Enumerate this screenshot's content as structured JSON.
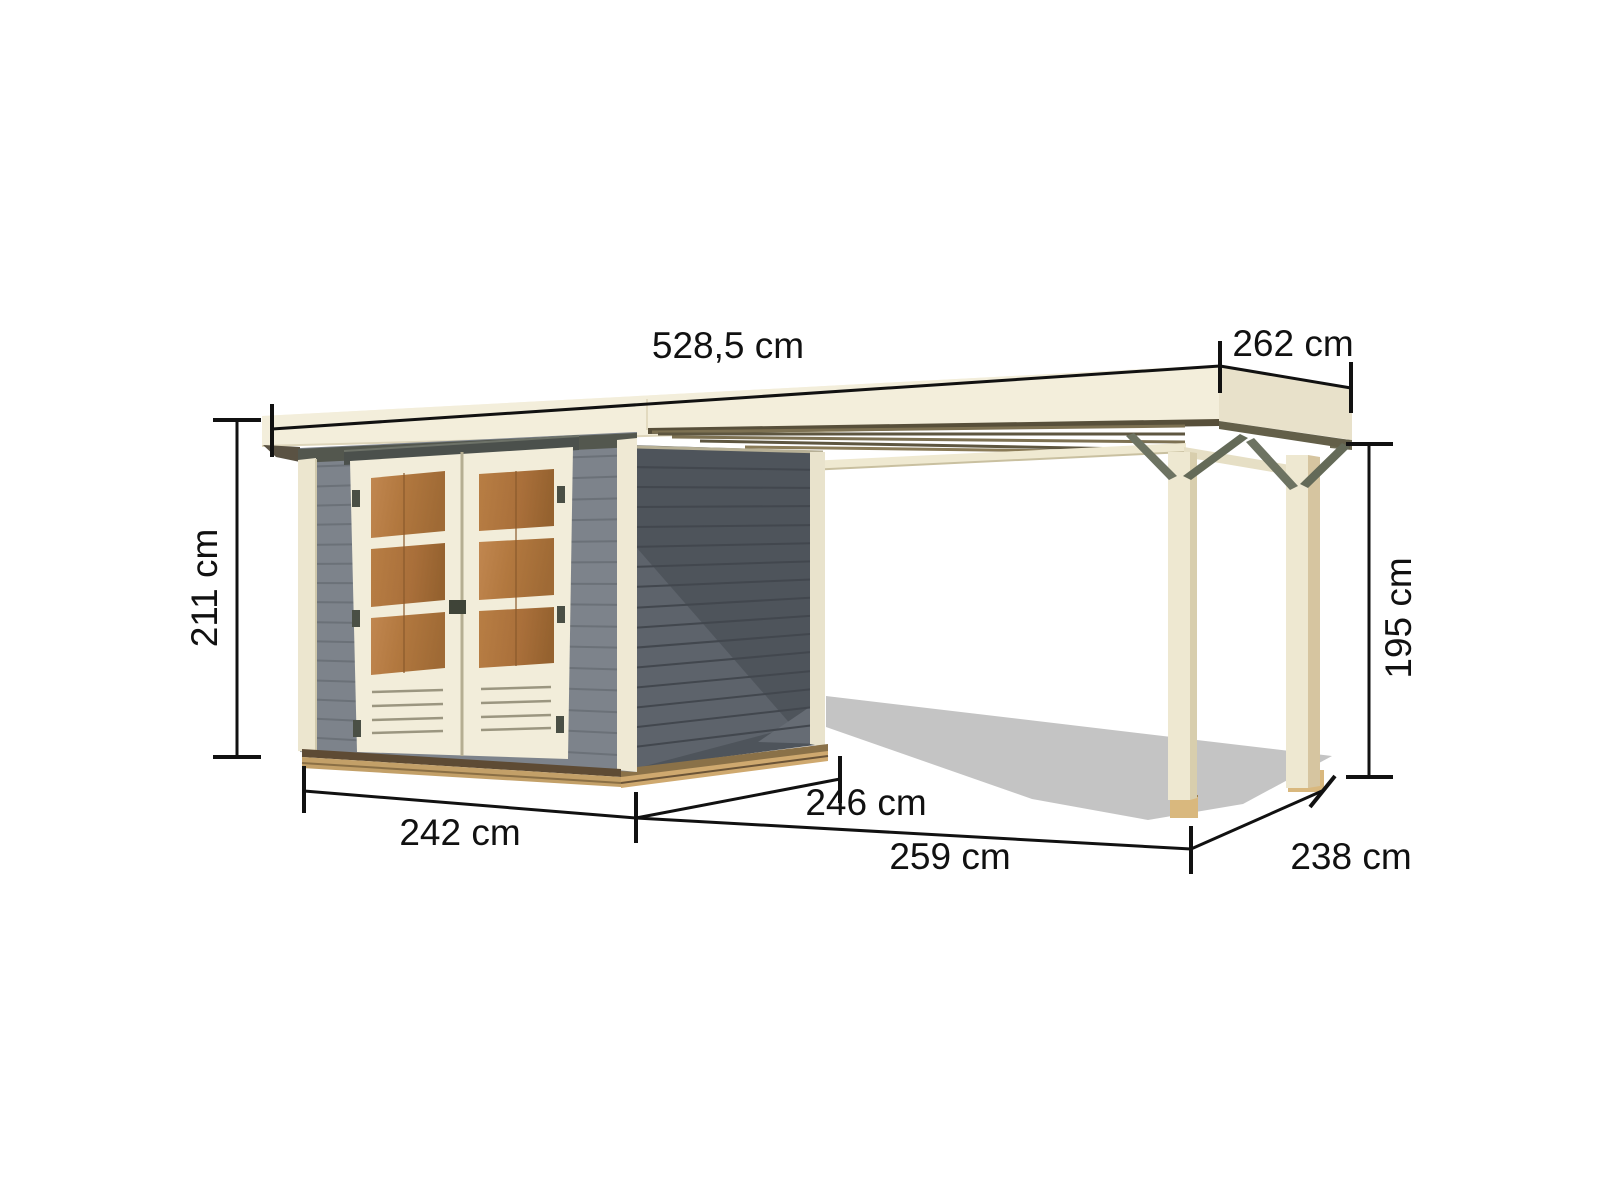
{
  "page": {
    "background": "#ffffff"
  },
  "diagram": {
    "unit": "cm",
    "labels": {
      "roof_total_width": "528,5 cm",
      "roof_side_depth": "262 cm",
      "shed_height": "211 cm",
      "annex_height": "195 cm",
      "shed_width": "242 cm",
      "shed_side_depth": "246 cm",
      "annex_width": "259 cm",
      "annex_side_depth": "238 cm"
    },
    "values": {
      "roof_total_width": 528.5,
      "roof_side_depth": 262,
      "shed_height": 211,
      "annex_height": 195,
      "shed_width": 242,
      "shed_side_depth": 246,
      "annex_width": 259,
      "annex_side_depth": 238
    },
    "colors": {
      "roof_cream": "#f3eedb",
      "roof_top_light": "#f8f4e6",
      "roof_end_shaded": "#e8e1ca",
      "trim_cream": "#ece6cf",
      "front_wall_gray": "#7d838b",
      "side_wall_gray": "#4e545b",
      "door_glass_amber": "#b2783f",
      "wood_beam_tan": "#c3a068",
      "brace_olive": "#6d7362",
      "ground_shadow_gray": "#c4c4c4",
      "dimension_line_black": "#111111"
    }
  }
}
